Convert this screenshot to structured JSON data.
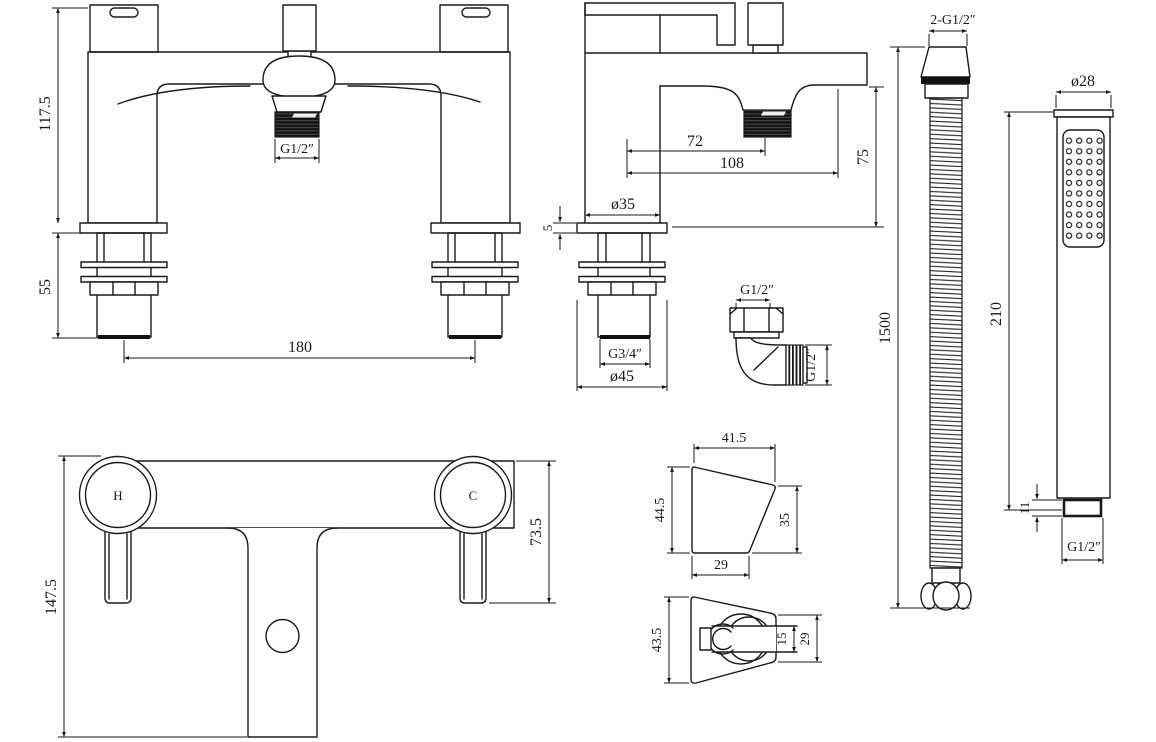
{
  "drawing": {
    "background": "#ffffff",
    "line_color": "#1a1a1a"
  },
  "views": {
    "front": {
      "dims": {
        "height": "117.5",
        "shank_length": "55",
        "tap_centres": "180",
        "shower_outlet_thread": "G1/2″"
      }
    },
    "side": {
      "dims": {
        "body_diameter": "ø35",
        "deck_thickness": "5",
        "spout_centre": "72",
        "spout_reach": "108",
        "spout_height": "75",
        "shank_thread": "G3/4″",
        "base_diameter": "ø45"
      }
    },
    "elbow": {
      "dims": {
        "nut_thread": "G1/2″",
        "outlet_thread": "G1/2″"
      }
    },
    "hose": {
      "dims": {
        "end_threads": "2-G1/2″",
        "length": "1500"
      }
    },
    "handset": {
      "dims": {
        "head_diameter": "ø28",
        "length": "210",
        "connector_length": "11",
        "connector_thread": "G1/2″"
      }
    },
    "plan": {
      "handle_labels": {
        "hot": "H",
        "cold": "C"
      },
      "dims": {
        "overall_depth": "147.5",
        "handle_projection": "73.5"
      }
    },
    "bracket_side": {
      "dims": {
        "top_width": "41.5",
        "height": "44.5",
        "front_height": "35",
        "base_width": "29"
      }
    },
    "bracket_top": {
      "dims": {
        "width": "43.5",
        "slot_width": "15",
        "holder_width": "29"
      }
    }
  }
}
